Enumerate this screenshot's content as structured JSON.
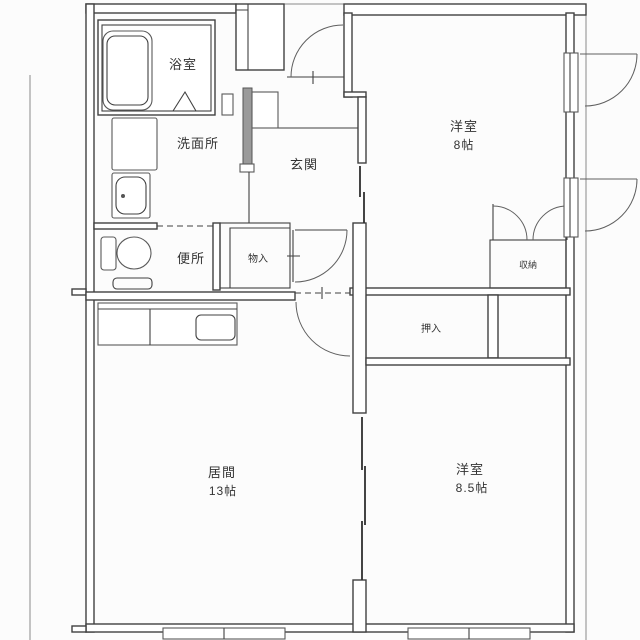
{
  "floorplan": {
    "rooms": {
      "bathroom": {
        "label": "浴室"
      },
      "washroom": {
        "label": "洗面所"
      },
      "entrance": {
        "label": "玄関"
      },
      "toilet": {
        "label": "便所"
      },
      "hall_storage": {
        "label": "物入"
      },
      "western_room_1": {
        "label": "洋室",
        "size": "8帖"
      },
      "closet": {
        "label": "収納"
      },
      "oshiire": {
        "label": "押入"
      },
      "living_room": {
        "label": "居間",
        "size": "13帖"
      },
      "western_room_2": {
        "label": "洋室",
        "size": "8.5帖"
      }
    },
    "colors": {
      "wall_line": "#414141",
      "exterior_line": "#8a8a8a",
      "shaded_wall": "#9a9a9a",
      "background": "#fcfcfc",
      "text": "#333333"
    }
  }
}
